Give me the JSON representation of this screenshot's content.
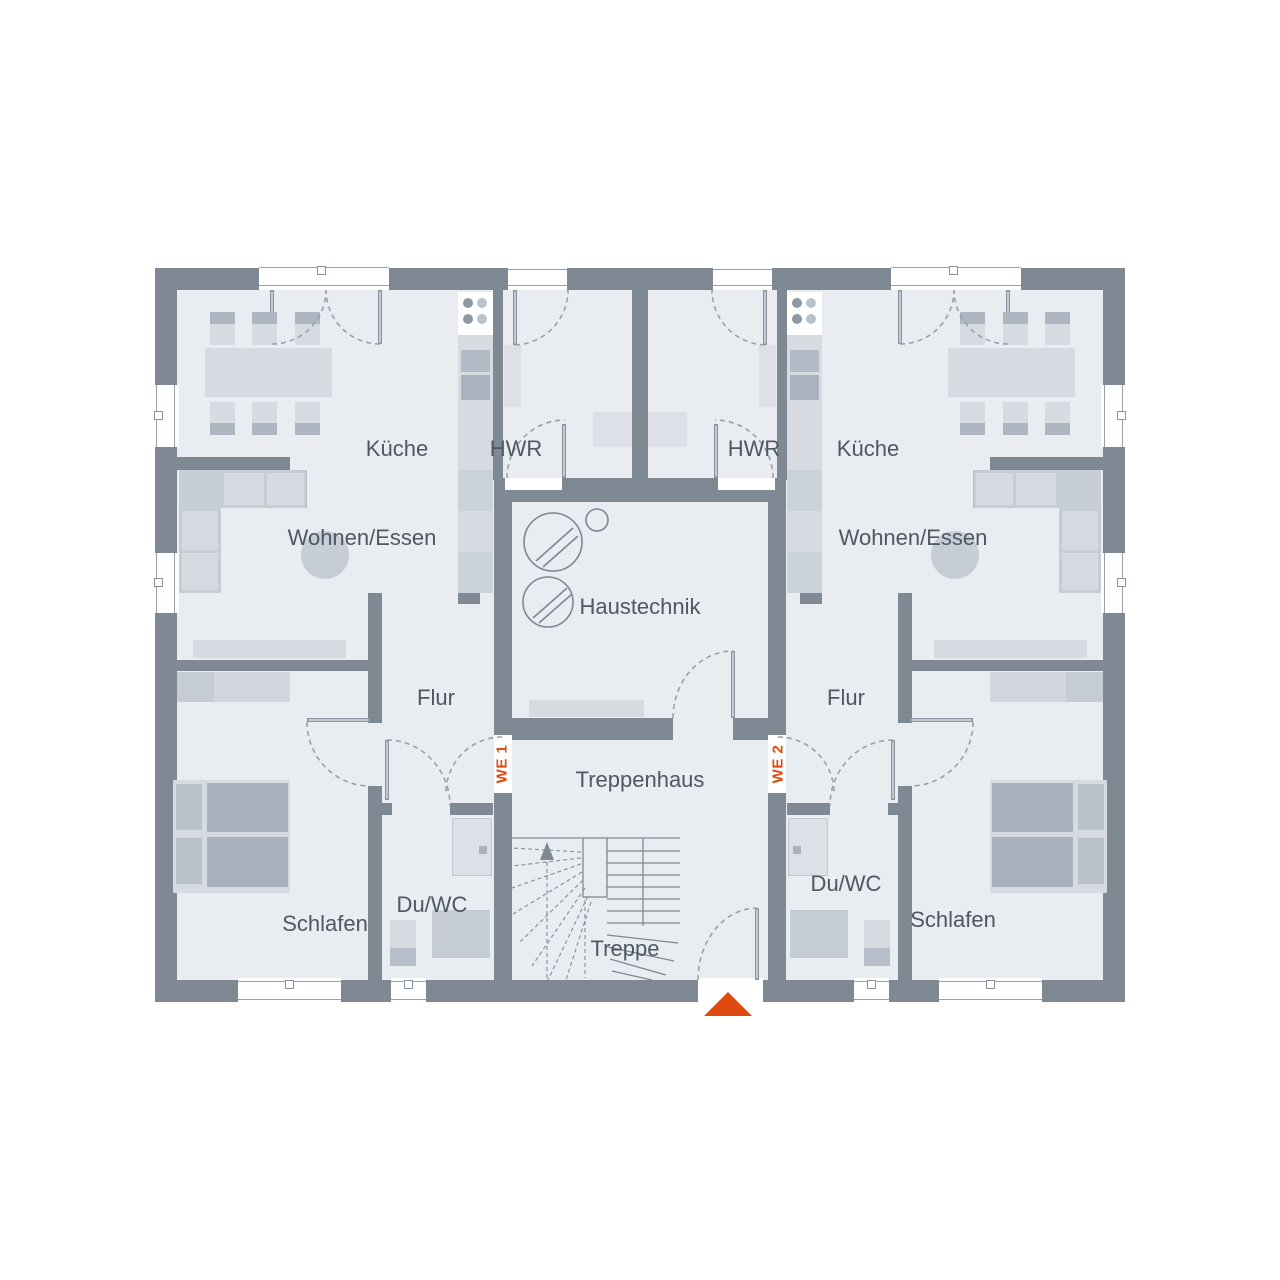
{
  "units": {
    "we1": {
      "label": "WE 1",
      "rooms": {
        "kueche": "Küche",
        "hwr": "HWR",
        "wohnen_essen": "Wohnen/Essen",
        "flur": "Flur",
        "du_wc": "Du/WC",
        "schlafen": "Schlafen"
      }
    },
    "we2": {
      "label": "WE 2",
      "rooms": {
        "kueche": "Küche",
        "hwr": "HWR",
        "wohnen_essen": "Wohnen/Essen",
        "flur": "Flur",
        "du_wc": "Du/WC",
        "schlafen": "Schlafen"
      }
    }
  },
  "common": {
    "haustechnik": "Haustechnik",
    "treppenhaus": "Treppenhaus",
    "treppe": "Treppe"
  },
  "colors": {
    "wall": "#7e8994",
    "floor": "#e9ecf1",
    "accent": "#de4a0f",
    "furniture_light": "#d6dbe2",
    "furniture_medium": "#c7cdd6",
    "furniture_dark": "#a9b1bd",
    "text": "#4d5863",
    "line": "#8f99a5"
  }
}
